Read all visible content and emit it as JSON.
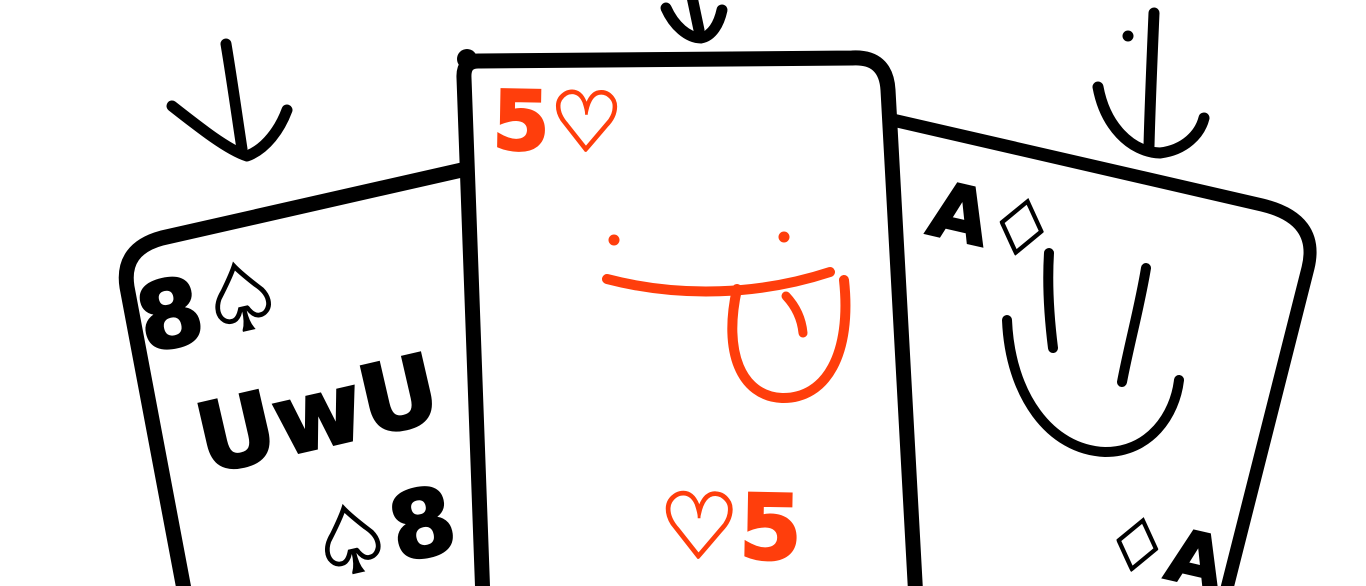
{
  "drawing": {
    "kind": "hand-drawn sketch of three playing cards",
    "background": "#ffffff",
    "ink_color": "#000000",
    "accent_color": "#ff3e0c"
  },
  "cards": [
    {
      "name": "eight-of-spades",
      "rank": "8",
      "suit": "spade",
      "corner_top": "8♤",
      "corner_bottom": "♤8",
      "face_text": "UwU",
      "ink": "#000000"
    },
    {
      "name": "five-of-hearts",
      "rank": "5",
      "suit": "heart",
      "corner_top": "5♡",
      "corner_bottom": "♡5",
      "face_text": "",
      "face": "tongue-out face (two dot eyes, mouth, tongue)",
      "ink": "#ff3e0c"
    },
    {
      "name": "ace-of-diamonds",
      "rank": "A",
      "suit": "diamond",
      "corner_top": "A♢",
      "corner_bottom": "♢A",
      "face_text": "",
      "face": "smiley face (two line eyes, smile)",
      "ink": "#000000"
    }
  ],
  "arrows": [
    {
      "name": "left-arrow",
      "direction": "down"
    },
    {
      "name": "middle-arrow",
      "direction": "down"
    },
    {
      "name": "right-arrow",
      "direction": "down",
      "detail": "dot beside stem"
    }
  ]
}
